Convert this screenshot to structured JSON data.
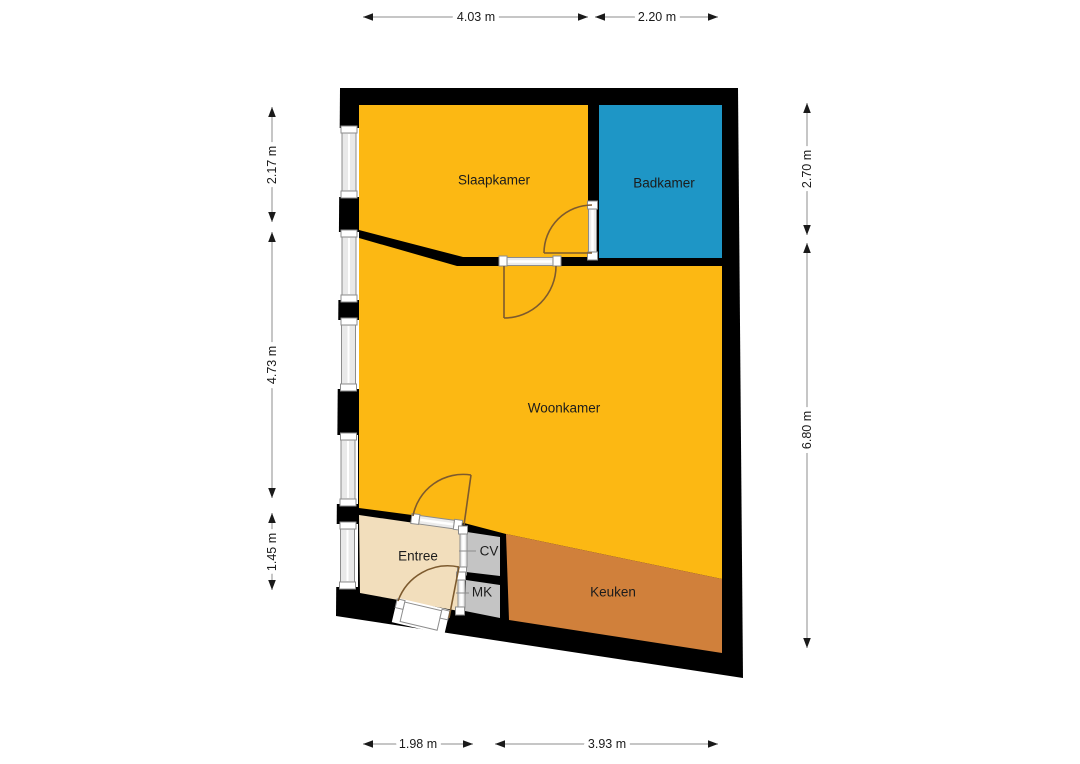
{
  "floorplan": {
    "wall_color": "#000000",
    "rooms": [
      {
        "id": "slaapkamer",
        "label": "Slaapkamer",
        "color": "#FCB813"
      },
      {
        "id": "badkamer",
        "label": "Badkamer",
        "color": "#1E96C6"
      },
      {
        "id": "woonkamer",
        "label": "Woonkamer",
        "color": "#FCB813"
      },
      {
        "id": "entree",
        "label": "Entree",
        "color": "#F2DEBC"
      },
      {
        "id": "cv",
        "label": "CV",
        "color": "#C4C4C4"
      },
      {
        "id": "mk",
        "label": "MK",
        "color": "#C4C4C4"
      },
      {
        "id": "keuken",
        "label": "Keuken",
        "color": "#D0803B"
      }
    ],
    "dimensions": {
      "top": [
        {
          "label": "4.03 m"
        },
        {
          "label": "2.20 m"
        }
      ],
      "bottom": [
        {
          "label": "1.98 m"
        },
        {
          "label": "3.93 m"
        }
      ],
      "left": [
        {
          "label": "2.17 m"
        },
        {
          "label": "4.73 m"
        },
        {
          "label": "1.45 m"
        }
      ],
      "right": [
        {
          "label": "2.70 m"
        },
        {
          "label": "6.80 m"
        }
      ]
    }
  }
}
